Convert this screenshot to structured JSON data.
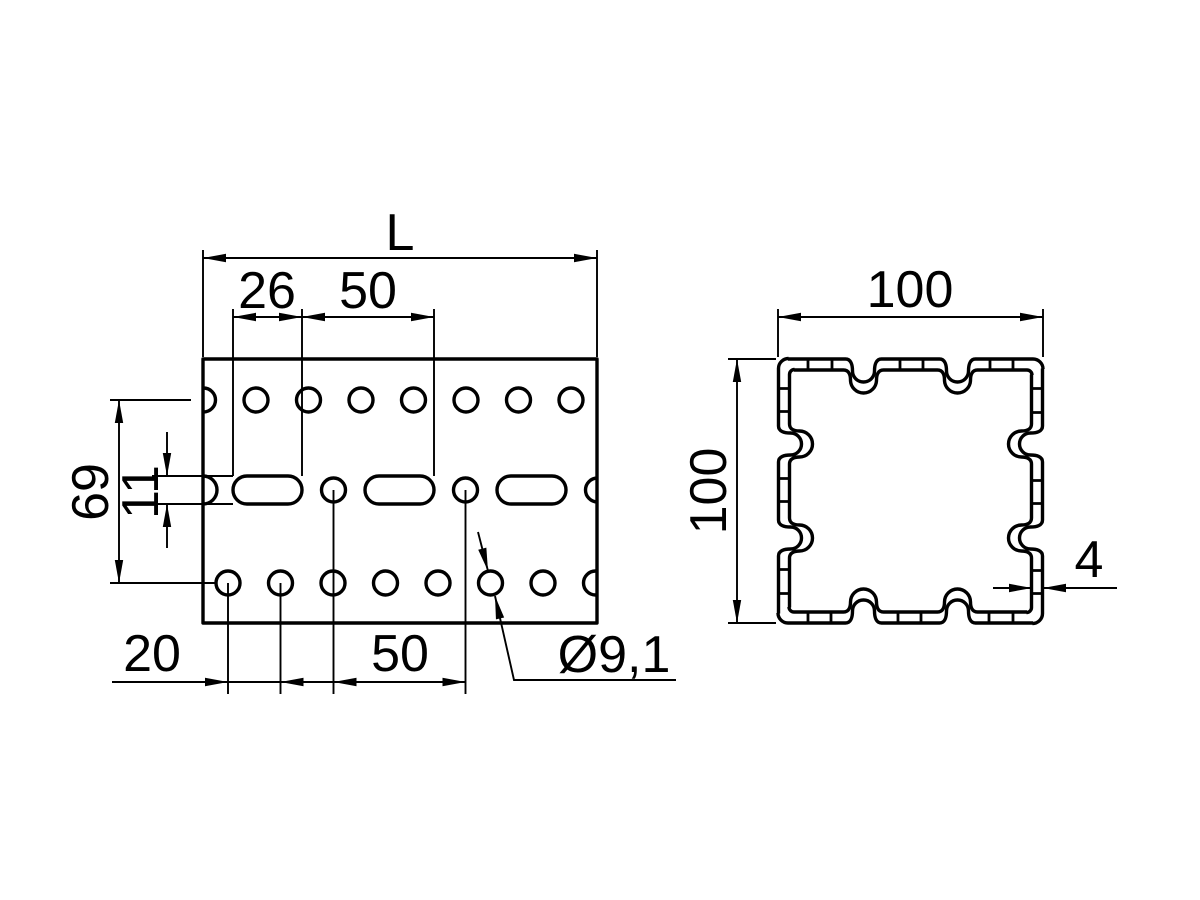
{
  "drawing": {
    "colors": {
      "line": "#000000",
      "background": "#ffffff"
    },
    "side_view": {
      "length_label": "L",
      "slot_length": "26",
      "slot_pitch": "50",
      "row_spacing": "69",
      "slot_width": "11",
      "hole_offset": "20",
      "hole_pitch": "50",
      "hole_diameter": "Ø9,1"
    },
    "section_view": {
      "width": "100",
      "height": "100",
      "wall_thickness": "4"
    }
  }
}
